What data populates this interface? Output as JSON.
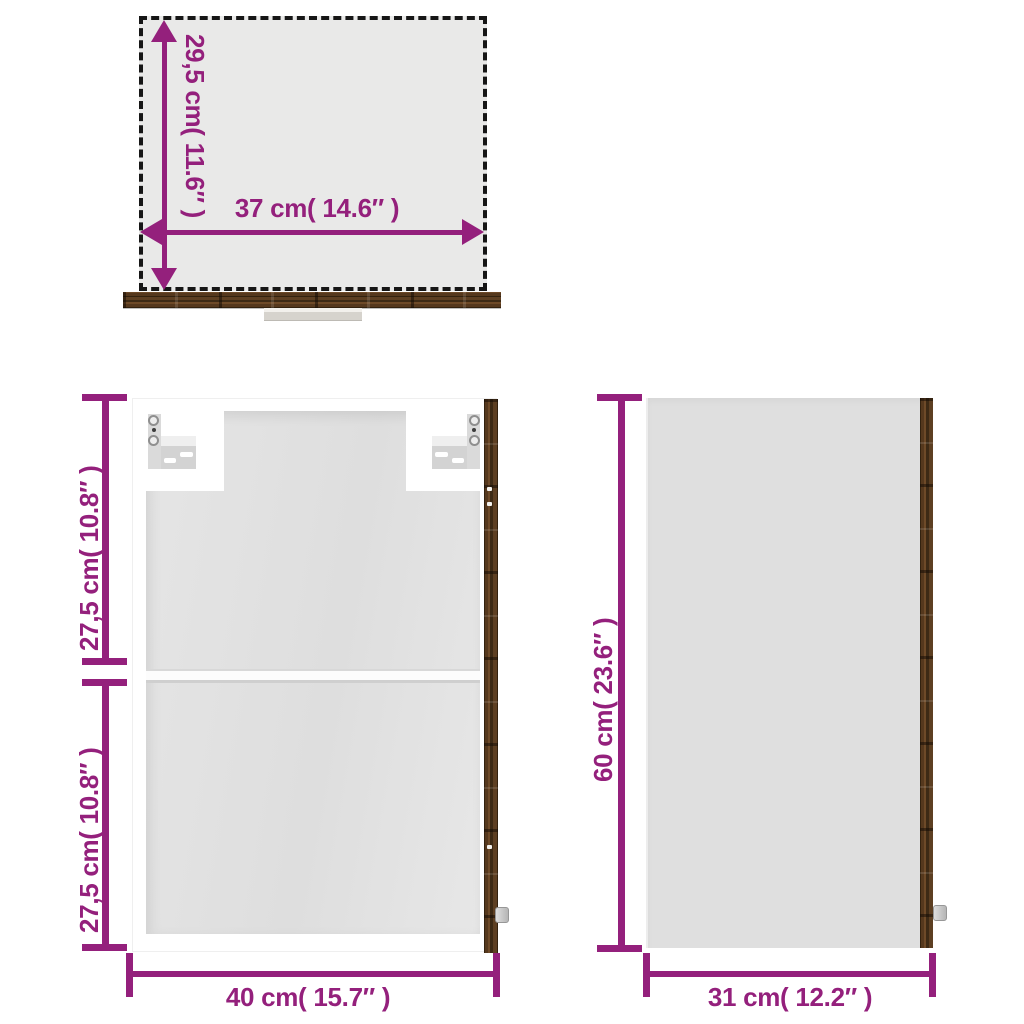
{
  "colors": {
    "accent": "#94207C",
    "dash": "#161616",
    "panel": "#e2e2e2",
    "side-panel": "#dfdfdf",
    "top-fill": "#e9e9e8"
  },
  "views": {
    "top": {
      "depth_label": "29,5 cm( 11.6″ )",
      "width_label": "37 cm( 14.6″ )"
    },
    "front": {
      "upper_height_label": "27,5 cm( 10.8″ )",
      "lower_height_label": "27,5 cm( 10.8″ )",
      "width_label": "40 cm( 15.7″ )"
    },
    "side": {
      "height_label": "60 cm( 23.6″ )",
      "width_label": "31 cm( 12.2″ )"
    }
  }
}
